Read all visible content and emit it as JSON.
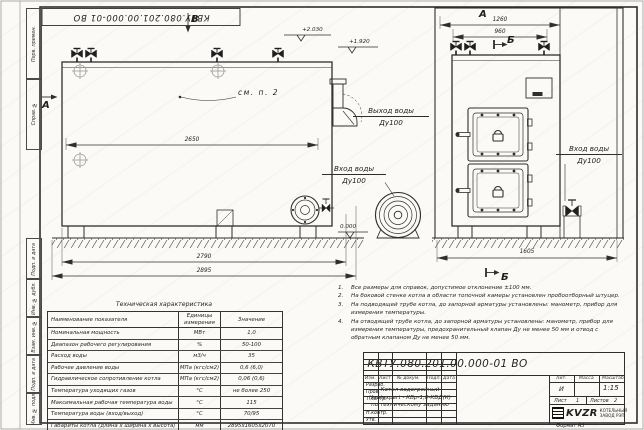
{
  "sheet": {
    "stamp_top": "КВТУ.080.201.00.000-01 ВО",
    "format_label": "Формат А3",
    "left_fields": [
      "Перв. примен.",
      "Справ. №",
      "Подп. и дата",
      "Инв. № дубл.",
      "Взам. инв. №",
      "Подп. и дата",
      "Инв. № подл."
    ]
  },
  "drawing": {
    "view_labels": {
      "top": "В",
      "left": "А",
      "front": "А",
      "section_top": "Б",
      "section_bottom": "Б"
    },
    "callout_note": "см. п. 2",
    "port_labels": {
      "outlet_line1": "Выход воды",
      "outlet_line2": "Ду100",
      "inlet_left_line1": "Вход воды",
      "inlet_left_line2": "Ду100",
      "inlet_right_line1": "Вход воды",
      "inlet_right_line2": "Ду100"
    },
    "dimensions": {
      "body_length": "2650",
      "base_length": "2790",
      "overall_length": "2895",
      "front_overall": "1260",
      "front_width": "960",
      "depth": "1605"
    },
    "elevations": {
      "top": "+2.030",
      "flue": "+1.920",
      "ground": "0.000"
    }
  },
  "notes": {
    "items": [
      {
        "num": "1.",
        "text": "Все размеры для справок, допустимое отклонение ±100 мм."
      },
      {
        "num": "2.",
        "text": "На боковой стенке котла в области топочной камеры установлен пробоотборный штуцер."
      },
      {
        "num": "3.",
        "text": "На подводящей трубе котла, до запорной арматуры установлены: манометр, прибор для измерения температуры."
      },
      {
        "num": "4.",
        "text": "На отводящей трубе котла, до запорной арматуры установлены: манометр, прибор для измерения температуры, предохранительный клапан Ду не менее 50 мм и отвод с обратным клапаном Ду не менее 50 мм."
      }
    ]
  },
  "tech_table": {
    "title": "Техническая характеристика",
    "headers": {
      "name": "Наименование показателя",
      "units1": "Единицы",
      "units2": "измерения",
      "value": "Значение"
    },
    "rows": [
      [
        "Номинальная мощность",
        "МВт",
        "1,0"
      ],
      [
        "Диапазон рабочего регулирования",
        "%",
        "50-100"
      ],
      [
        "Расход воды",
        "м3/ч",
        "35"
      ],
      [
        "Рабочее давление воды",
        "МПа (кгс/см2)",
        "0,6 (6,0)"
      ],
      [
        "Гидравлическое сопротивление котла",
        "МПа (кгс/см2)",
        "0,06 (0,6)"
      ],
      [
        "Температура уходящих газов",
        "°С",
        "не более 250"
      ],
      [
        "Максимальная рабочая температура воды",
        "°С",
        "115"
      ],
      [
        "Температура воды (вход/выход)",
        "°С",
        "70/95"
      ],
      [
        "Габариты котла (длина х ширина х высота)",
        "мм",
        "2895х1605х2070"
      ]
    ]
  },
  "title_block": {
    "doc_number": "КВТУ.080.201.00.000-01 ВО",
    "product_name_line1": "Котел водогрейный",
    "product_name_line2": "Heatexpert - КВр-1,0-КБД(К)",
    "product_name_line3": "по техническому заданию",
    "header_cells": [
      "Изм.",
      "Лист",
      "№ докум.",
      "Подп.",
      "Дата"
    ],
    "approval_rows": [
      "Разраб.",
      "Пров.",
      "Т.контр.",
      "",
      "Н.контр.",
      "Утв."
    ],
    "lit_header": "Лит.",
    "mass_header": "Масса",
    "scale_header": "Масштаб",
    "lit_value": "И",
    "scale_value": "1:15",
    "sheet_label": "Лист",
    "sheet_value": "1",
    "sheets_label": "Листов",
    "sheets_value": "2",
    "logo_text": "KVZR",
    "logo_sub1": "КОТЕЛЬНЫЙ",
    "logo_sub2": "ЗАВОД РЭП"
  }
}
